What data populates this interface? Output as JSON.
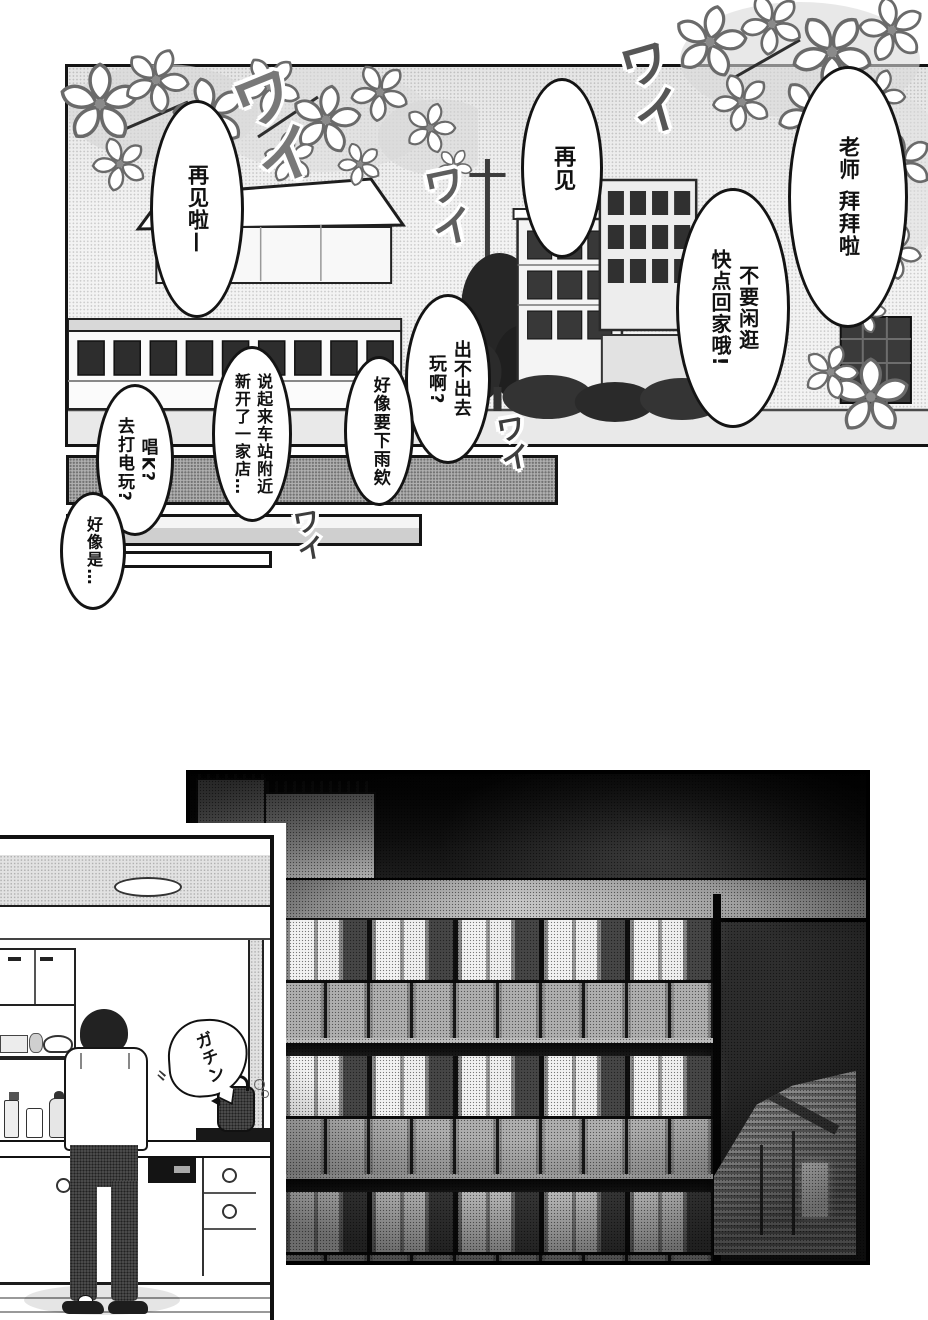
{
  "page": {
    "width": 928,
    "height": 1320,
    "background": "#ffffff"
  },
  "colors": {
    "ink": "#141414",
    "paper": "#ffffff",
    "tone_light": "#d6d6d6",
    "tone_mid": "#b0b0b0",
    "night_sky": "#1c1c1c"
  },
  "panels": {
    "school": {
      "bubbles": {
        "bye_la": "再见啦—",
        "bye": "再见",
        "teacher_bye": "老师 拜拜啦",
        "dont_loiter": "不要闲逛\n快点回家哦!",
        "going_out": "出不出去\n玩啊?",
        "rain": "好像要下雨欸",
        "new_shop": "说起来车站附近\n新开了一家店…",
        "karaoke": "唱K?\n去打电玩?",
        "maybe": "好像是…"
      },
      "sfx": {
        "wai": "ワイ"
      }
    },
    "night": {},
    "kitchen": {
      "sfx": {
        "gachin": "ガチン"
      },
      "motion_mark": "〃"
    }
  }
}
